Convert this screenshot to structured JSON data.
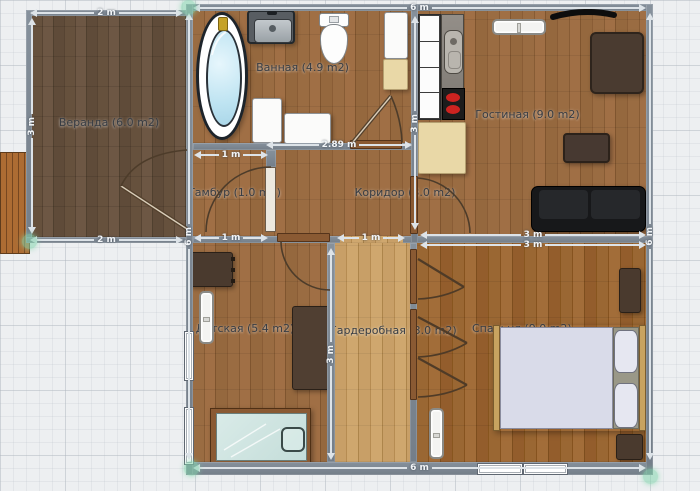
{
  "plan": {
    "rooms": {
      "veranda": "Веранда (6.0 m2)",
      "bathroom": "Ванная (4.9 m2)",
      "living": "Гостиная (9.0 m2)",
      "tambour": "Тамбур (1.0 m2)",
      "corridor": "Коридор (3.0 m2)",
      "nursery": "Детская (5.4 m2)",
      "wardrobe": "Гардеробная (3.0 m2)",
      "bedroom": "Спальня (9.0 m2)"
    },
    "dimensions": {
      "veranda_top": "2 m",
      "veranda_left": "3 m",
      "veranda_bottom": "2 m",
      "house_top": "6 m",
      "house_left": "6 m",
      "house_right": "6 m",
      "house_bottom": "6 m",
      "bath_width": "2.89 m",
      "tambour_top": "1 m",
      "tambour_bottom": "1 m",
      "corridor_opening": "1 m",
      "living_left": "3 m",
      "living_bottom": "3 m",
      "bedroom_top": "3 m",
      "nursery_right": "3 m"
    },
    "colors": {
      "wall": "#7b8591",
      "floor_veranda": "#5e4b3a",
      "floor_wood": "#946740",
      "floor_light": "#c59c64",
      "bed_linen": "#d9dbe9",
      "bath_water": "#bfe4f2",
      "handle_accent": "#8ed3b8"
    }
  }
}
